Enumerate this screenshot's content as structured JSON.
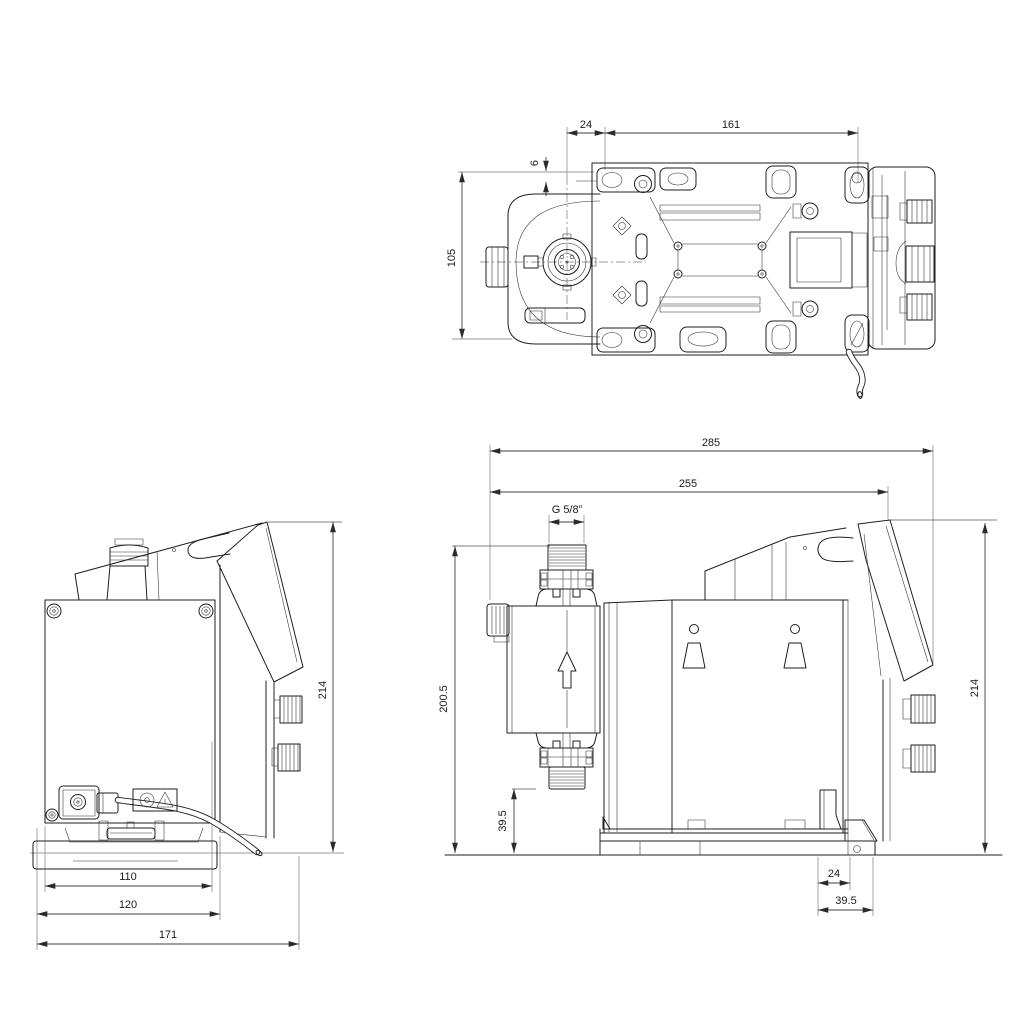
{
  "colors": {
    "background": "#ffffff",
    "line": "#1f1f1f",
    "dimension": "#3d3d3d",
    "extension": "#9a9a9a"
  },
  "views": {
    "top": {
      "dims": {
        "offset_24": "24",
        "length_161": "161",
        "offset_6": "6",
        "width_105": "105"
      }
    },
    "rear": {
      "dims": {
        "height_214": "214",
        "width_110": "110",
        "width_120": "120",
        "width_171": "171"
      }
    },
    "side": {
      "dims": {
        "width_285": "285",
        "width_255": "255",
        "thread_size": "G 5/8”",
        "height_200_5": "200.5",
        "height_214": "214",
        "height_39_5": "39.5",
        "offset_24": "24",
        "offset_39_5": "39.5"
      }
    }
  }
}
